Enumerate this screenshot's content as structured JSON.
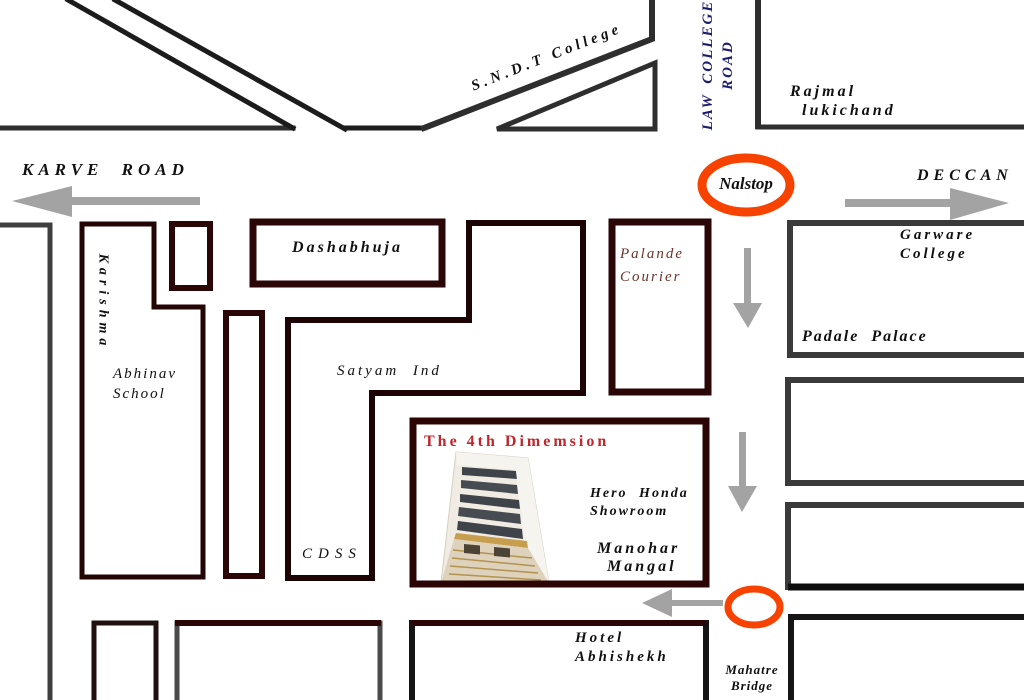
{
  "roads": {
    "karve": "KARVE ROAD",
    "sndt": "S.N.D.T College",
    "law_college": {
      "line1": "LAW COLLEGE",
      "line2": "ROAD"
    },
    "deccan": "DECCAN"
  },
  "landmarks": {
    "nalstop": "Nalstop",
    "rajmal": {
      "line1": "Rajmal",
      "line2": "lukichand"
    },
    "karishma": "Karishma",
    "abhinav": {
      "line1": "Abhinav",
      "line2": "School"
    },
    "dashabhuja": "Dashabhuja",
    "satyam": "Satyam Ind",
    "palande": {
      "line1": "Palande",
      "line2": "Courier"
    },
    "garware": {
      "line1": "Garware",
      "line2": "College"
    },
    "padale": "Padale Palace",
    "cdss": "CDSS",
    "hero_honda": {
      "line1": "Hero Honda",
      "line2": "Showroom"
    },
    "manohar": {
      "line1": "Manohar",
      "line2": "Mangal"
    },
    "hotel": {
      "line1": "Hotel",
      "line2": "Abhishekh"
    },
    "mahatre": {
      "line1": "Mahatre",
      "line2": "Bridge"
    }
  },
  "destination": {
    "title": "The 4th Dimemsion"
  },
  "colors": {
    "highlight_orange": "#f84300",
    "road_label_navy": "#1b1b6f",
    "destination_red": "#c0262c",
    "block_maroon": "#2a0606",
    "block_gray": "#3a3a3a",
    "road_black": "#1c1c1c",
    "arrow_gray": "#a3a3a3",
    "palande_brown": "#6b352b"
  }
}
